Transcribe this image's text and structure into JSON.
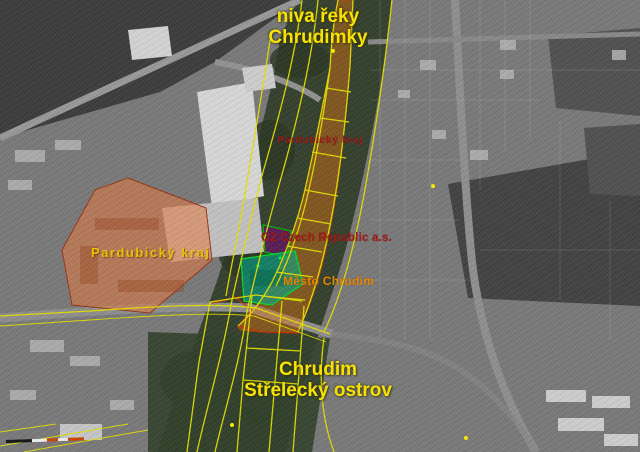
{
  "map": {
    "type": "aerial-cadastral-map",
    "colors": {
      "cadastral_line": "#e6e200",
      "boundary_red": "#c53000",
      "point_marker": "#ffee00"
    },
    "labels": {
      "floodplain": {
        "line1": "niva řeky",
        "line2": "Chrudimky",
        "color": "#ffe800"
      },
      "region_strip": {
        "text": "Pardubický kraj",
        "color": "#a01515"
      },
      "region_parcel": {
        "text": "Pardubický kraj",
        "color": "#eec800"
      },
      "o2": {
        "text": "O2 Czech Republic a.s.",
        "color": "#aa1414"
      },
      "city": {
        "text": "Město Chrudim",
        "color": "#ee8800"
      },
      "island": {
        "line1": "Chrudim",
        "line2": "Střelecký ostrov",
        "color": "#ffe800"
      }
    },
    "overlays": {
      "strip": {
        "owner": "Pardubický kraj",
        "fill": "rgba(226,116,16,0.45)",
        "stroke": "#c84400"
      },
      "parcel_left": {
        "owner": "Pardubický kraj",
        "fill": "rgba(232,122,62,0.55)",
        "stroke": "#9a3418"
      },
      "parcel_o2": {
        "owner": "O2 Czech Republic a.s.",
        "fill": "rgba(96,24,92,0.85)",
        "stroke": "#00b400"
      },
      "parcel_city": {
        "owner": "Město Chrudim",
        "fill": "rgba(0,170,140,0.6)",
        "stroke": "#00dc28"
      }
    },
    "scalebar": {
      "segments": [
        {
          "color": "#141414"
        },
        {
          "color": "#f2f2f2"
        },
        {
          "color": "#cc4400"
        },
        {
          "color": "#f0f0f0"
        },
        {
          "color": "#cc4400"
        }
      ]
    }
  }
}
